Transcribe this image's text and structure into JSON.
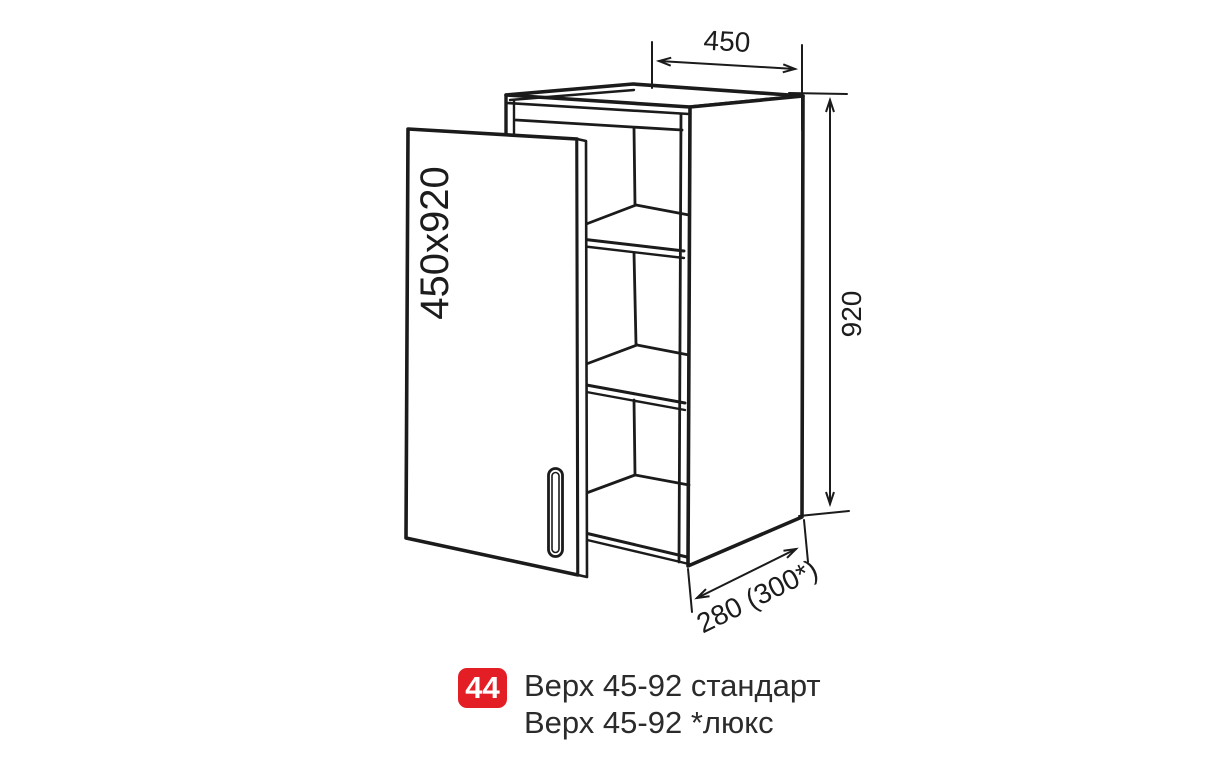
{
  "drawing": {
    "door_label": "450x920",
    "dim_width": "450",
    "dim_height": "920",
    "dim_depth": "280 (300*)"
  },
  "caption": {
    "badge": "44",
    "line1": "Верх 45-92 стандарт",
    "line2": "Верх 45-92 *люкс"
  },
  "colors": {
    "line": "#1b1b1b",
    "badge_red": "#e31e24",
    "caption_text": "#2b2b2b",
    "background": "#ffffff"
  }
}
